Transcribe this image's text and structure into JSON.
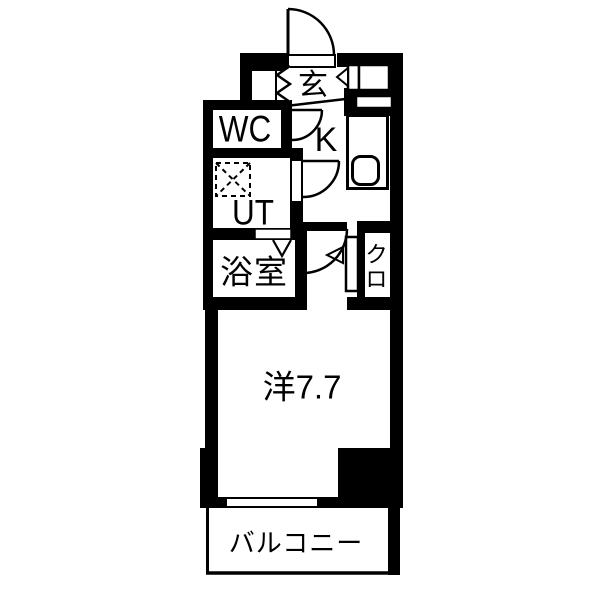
{
  "floorplan": {
    "title": "1K apartment floor plan",
    "rooms": {
      "genkan": {
        "label": "玄"
      },
      "wc": {
        "label": "WC"
      },
      "kitchen": {
        "label": "K"
      },
      "utility": {
        "label": "UT"
      },
      "bathroom": {
        "label": "浴室"
      },
      "closet": {
        "label": "クロ"
      },
      "main_room": {
        "label": "洋7.7"
      },
      "balcony": {
        "label": "バルコニー"
      }
    },
    "icons": [
      "entrance-door-arc",
      "wc-door-arc",
      "utility-door-arc",
      "main-room-door-arc",
      "folding-door-icon",
      "bath-folding-door-icon",
      "washing-machine-icon",
      "kitchen-sink-icon",
      "shoe-cabinet",
      "closet-door-panel",
      "window"
    ],
    "colors": {
      "wall": "#000000",
      "floor": "#ffffff",
      "text": "#000000"
    }
  }
}
